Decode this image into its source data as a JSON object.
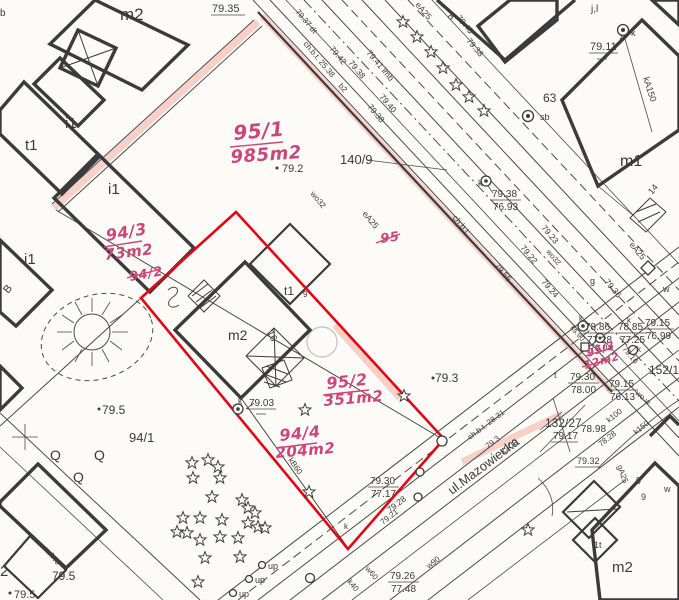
{
  "map_type": "cadastral-survey-scan",
  "colors": {
    "paper": "#fcfbf7",
    "ink": "#3b3b3b",
    "red_boundary": "#e30613",
    "handwriting": "#cb477a",
    "highlight": "#f39487"
  },
  "street": {
    "name": "ul.Mazowiecka"
  },
  "red_annotations": {
    "p95_1": {
      "number": "95/1",
      "area": "985m2"
    },
    "p94_3": {
      "number": "94/3",
      "area": "73m2"
    },
    "p95_2": {
      "number": "95/2",
      "area": "351m2"
    },
    "p94_4": {
      "number": "94/4",
      "area": "204m2"
    },
    "p95_3_crossed": {
      "number": "95/3",
      "area": "12m2"
    },
    "crossed_94_2": "94/2",
    "crossed_95": "95"
  },
  "parcels": {
    "p140_9": "140/9",
    "p94_1": "94/1",
    "p152_1": "152/1",
    "p132_27": "132/27",
    "p63": "63",
    "p2": "2"
  },
  "buildings": {
    "m2": "m2",
    "m1": "m1",
    "t1": "t1",
    "i1": "i1",
    "b1t": "1t",
    "b_rot": "B",
    "jl": "j,l",
    "n8": "8",
    "n9": "9",
    "n16": "16",
    "n14": "14",
    "b_edge": "b"
  },
  "elevations": {
    "e7935": "79.35",
    "e792": "79.2",
    "e793": "79.3",
    "e7911": "79.11",
    "e7903": "79.03",
    "e795": "79.5",
    "e7945": "79.45",
    "e7938": "79.38",
    "e7942": "79.42",
    "e7940": "79.40",
    "e7937dt": "79.37 dt",
    "e7941imb": "79.41 imb",
    "e7922": "79.22",
    "e7923": "79.23",
    "e7924": "79.24",
    "e7936": "79.36",
    "e7955": "79.55",
    "e7917": "79.17",
    "e7898": "78.98",
    "e7828": "78.28",
    "e7932": "79.32",
    "e7916": "79.16",
    "e7928": "79.28",
    "e7921": "79.21",
    "e7904": "79.04"
  },
  "fractions": {
    "f_7938_7693": {
      "top": "79.38",
      "bottom": "76.93"
    },
    "f_7886_7728": {
      "top": "78.86",
      "bottom": "77.28"
    },
    "f_7885_7725": {
      "top": "78.85",
      "bottom": "77.25"
    },
    "f_7915_7699": {
      "top": "79.15",
      "bottom": "76.99"
    },
    "f_7915_7613": {
      "top": "79.15",
      "bottom": "76.13"
    },
    "f_7930_7800": {
      "top": "79.30",
      "bottom": "78.00"
    },
    "f_7930_7717": {
      "top": "79.30",
      "bottom": "77.17"
    },
    "f_7926_7748": {
      "top": "79.26",
      "bottom": "77.48"
    }
  },
  "utilities": {
    "k": "k",
    "w": "w",
    "g": "g",
    "t": "t",
    "sb": "sb",
    "up": "up",
    "q": "Q",
    "ka150": "kA150",
    "k200": "k200",
    "k150": "k150",
    "k100": "k100",
    "k40": "k40",
    "kb60": "kB60",
    "ks90": "ks.90",
    "ga25": "gA25",
    "ea25": "eA25",
    "wo32": "wo32",
    "wow": "wo.w",
    "w90": "w90",
    "w60": "w60",
    "wa40": "wA40",
    "b2": "b2",
    "chbt_top": "ch.b.t. 25.38",
    "chbt_mid": "ch.b.t.",
    "chbt_low": "ch.b.t. 28.31"
  }
}
